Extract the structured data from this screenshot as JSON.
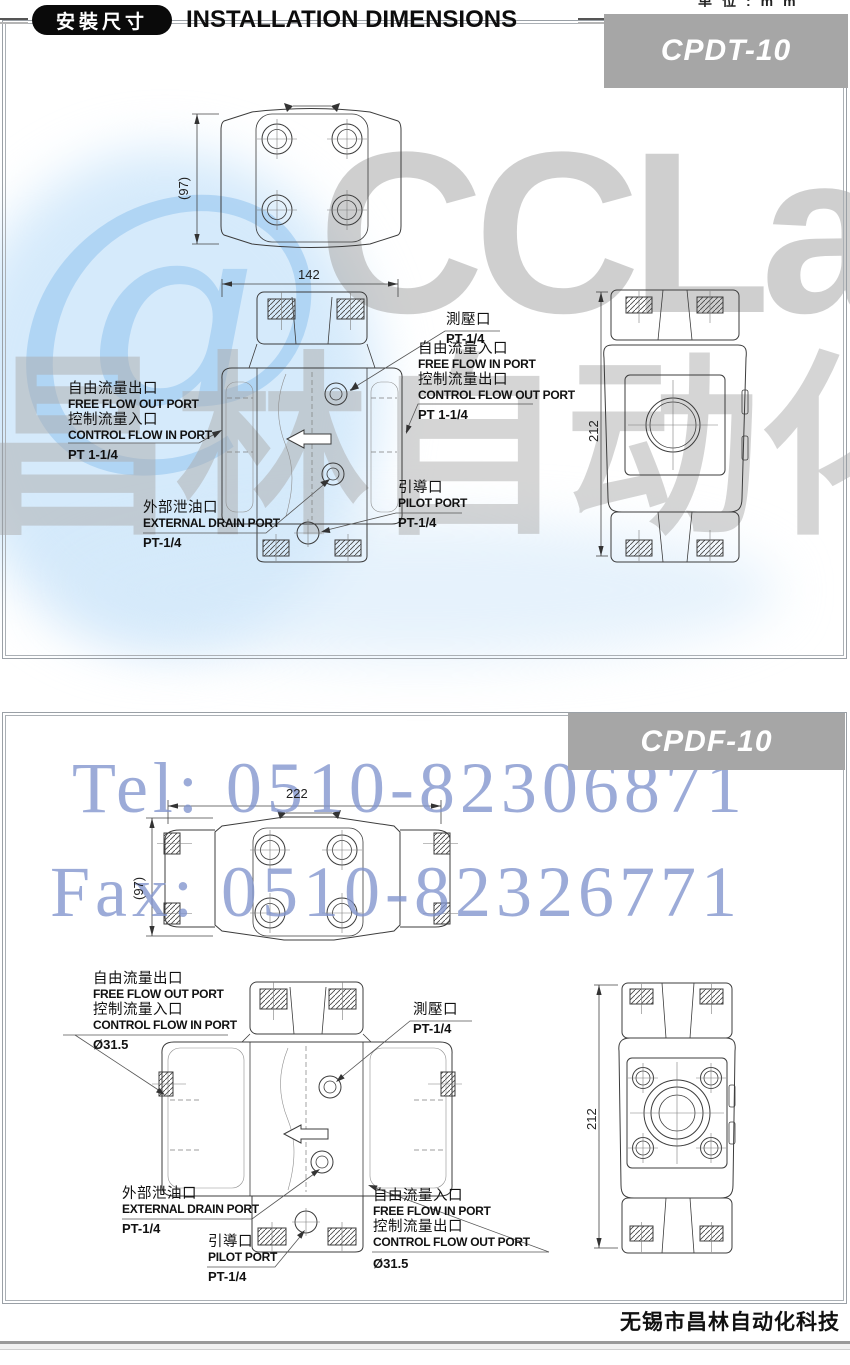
{
  "page": {
    "top_fragment": "单位:mm",
    "footer": "无锡市昌林自动化科技"
  },
  "header": {
    "badge": "安裝尺寸",
    "title": "INSTALLATION DIMENSIONS"
  },
  "watermark": {
    "at": "@",
    "logo": "CCLair",
    "logo_cn": "昌林自动化",
    "tel": "Tel: 0510-82306871",
    "fax": "Fax: 0510-82326771",
    "blue": "#8094cd",
    "gray": "#aaaaaa",
    "light_blue": "#d9eaf9"
  },
  "s1": {
    "model": "CPDT-10",
    "dim_width": "142",
    "dim_height": "212",
    "dim_depth": "(97)",
    "test_cn": "測壓口",
    "test_size": "PT-1/4",
    "in_cn": "自由流量入口",
    "in_en": "FREE FLOW IN PORT",
    "ctrl_out_cn": "控制流量出口",
    "ctrl_out_en": "CONTROL FLOW OUT PORT",
    "in_size": "PT 1-1/4",
    "out_cn": "自由流量出口",
    "out_en": "FREE FLOW OUT PORT",
    "ctrl_in_cn": "控制流量入口",
    "ctrl_in_en": "CONTROL FLOW IN PORT",
    "out_size": "PT 1-1/4",
    "drain_cn": "外部泄油口",
    "drain_en": "EXTERNAL DRAIN PORT",
    "drain_size": "PT-1/4",
    "pilot_cn": "引導口",
    "pilot_en": "PILOT PORT",
    "pilot_size": "PT-1/4"
  },
  "s2": {
    "model": "CPDF-10",
    "dim_width": "222",
    "dim_height": "212",
    "dim_depth": "(97)",
    "test_cn": "測壓口",
    "test_size": "PT-1/4",
    "in_cn": "自由流量入口",
    "in_en": "FREE FLOW IN PORT",
    "ctrl_out_cn": "控制流量出口",
    "ctrl_out_en": "CONTROL FLOW OUT PORT",
    "in_size": "Ø31.5",
    "out_cn": "自由流量出口",
    "out_en": "FREE FLOW OUT PORT",
    "ctrl_in_cn": "控制流量入口",
    "ctrl_in_en": "CONTROL FLOW IN PORT",
    "out_size": "Ø31.5",
    "drain_cn": "外部泄油口",
    "drain_en": "EXTERNAL DRAIN PORT",
    "drain_size": "PT-1/4",
    "pilot_cn": "引導口",
    "pilot_en": "PILOT PORT",
    "pilot_size": "PT-1/4"
  }
}
